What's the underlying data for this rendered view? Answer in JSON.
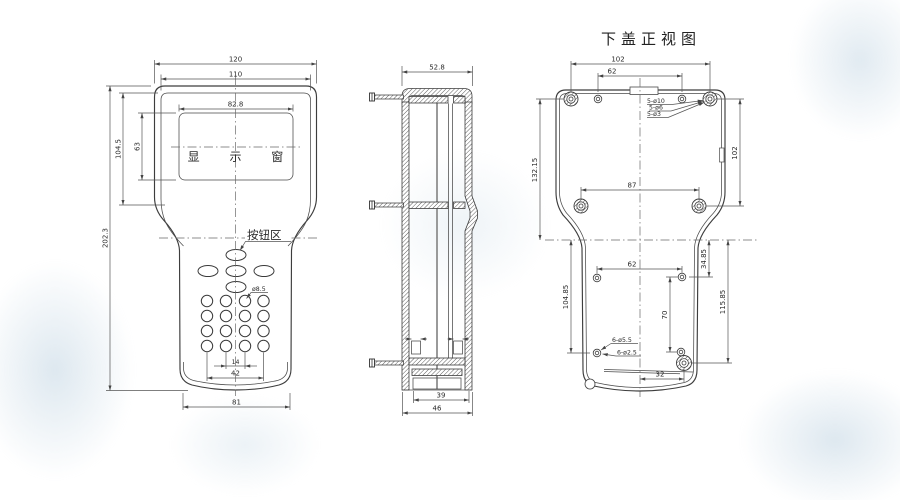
{
  "front_view": {
    "display_window_label": "显 示 窗",
    "button_area_label": "按钮区",
    "dim_overall_width": "120",
    "dim_face_width": "110",
    "dim_window_width": "82.8",
    "dim_face_height": "104.5",
    "dim_window_height": "63",
    "dim_overall_height": "202.3",
    "dim_button_diameter": "ø8.5",
    "dim_key_pitch": "14",
    "dim_key_span": "42",
    "dim_bottom_width": "81"
  },
  "side_view": {
    "dim_top_width": "52.8",
    "dim_bottom_inner_width": "39",
    "dim_bottom_outer_width": "46"
  },
  "bottom_cover_view": {
    "title": "下盖正视图",
    "dim_boss_span": "102",
    "dim_top_hole_span": "62",
    "dim_height_left": "132.15",
    "dim_height_right": "102",
    "dim_lower_boss_span": "87",
    "dim_hole_offset_left": "104.85",
    "dim_hole_offset_top": "34.85",
    "dim_boss_offset_right": "115.85",
    "dim_hole_span": "62",
    "dim_hole_pitch": "70",
    "dim_boss_offset_x": "32",
    "note_boss_od": "5-ø10",
    "note_boss_mid": "5-ø6",
    "note_boss_hole": "5-ø3",
    "note_hole_cb": "6-ø5.5",
    "note_hole_id": "6-ø2.5"
  }
}
